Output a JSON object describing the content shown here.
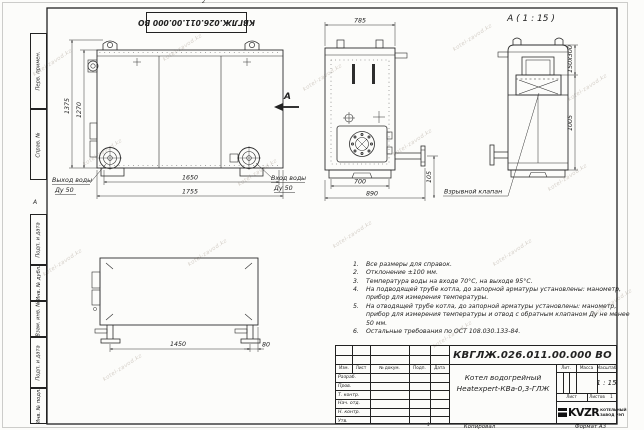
{
  "watermark": "kotel-zavod.kz",
  "frame": {
    "zone_top": "2",
    "zone_left": "А",
    "copy_tick": "1"
  },
  "stamp_top": {
    "doc_number": "КВГЛЖ.026.011.00.000 ВО"
  },
  "sidebar": {
    "items": [
      {
        "label": "Перв. примен."
      },
      {
        "label": "Справ. №"
      },
      {
        "label": "Подп. и дата"
      },
      {
        "label": "Инв. № дубл."
      },
      {
        "label": "Взам. инв. №"
      },
      {
        "label": "Подп. и дата"
      },
      {
        "label": "Инв. № подл."
      }
    ]
  },
  "views": {
    "side": {
      "dim_height_total": "1375",
      "dim_height_body": "1270",
      "dim_width_inner": "1650",
      "dim_width_total": "1755",
      "outlet_label": "Выход воды",
      "outlet_dn": "Ду 50",
      "inlet_label": "Вход воды",
      "inlet_dn": "Ду 50",
      "section_arrow": "А"
    },
    "front": {
      "dim_width_top": "785",
      "dim_width_inner": "700",
      "dim_width_total": "890",
      "dim_pipe_height": "105"
    },
    "section": {
      "title": "А ( 1 : 15 )",
      "dim_opening": "150х300",
      "dim_height": "1005",
      "valve_label": "Взрывной клапан"
    },
    "plan": {
      "dim_leg_span": "1450",
      "dim_edge_offset": "80"
    }
  },
  "notes": [
    {
      "num": "1.",
      "text": "Все размеры для справок."
    },
    {
      "num": "2.",
      "text": "Отклонение ±100 мм."
    },
    {
      "num": "3.",
      "text": "Температура воды на входе 70°С, на выходе 95°С."
    },
    {
      "num": "4.",
      "text": "На подводящей трубе котла, до запорной арматуры установлены: манометр, прибор для измерения температуры."
    },
    {
      "num": "5.",
      "text": "На отводящей трубе котла, до запорной арматуры установлены: манометр, прибор для измерения температуры и отвод с обратным клапаном Ду не менее 50 мм."
    },
    {
      "num": "6.",
      "text": "Остальные требования по ОСТ 108.030.133-84."
    }
  ],
  "title_block": {
    "doc_number": "КВГЛЖ.026.011.00.000 ВО",
    "product_line1": "Котел водогрейный",
    "product_line2": "Heatexpert-КВа-0,3-ГЛЖ",
    "rev_cols": [
      {
        "label": "Изм."
      },
      {
        "label": "Лист"
      },
      {
        "label": "№ докум."
      },
      {
        "label": "Подп."
      },
      {
        "label": "Дата"
      }
    ],
    "staff_rows": [
      {
        "label": "Разраб."
      },
      {
        "label": "Пров."
      },
      {
        "label": "Т. контр."
      },
      {
        "label": "Нач. отд."
      },
      {
        "label": "Н. контр."
      },
      {
        "label": "Утв."
      }
    ],
    "lit_label": "Лит.",
    "mass_label": "Масса",
    "scale_label": "Масштаб",
    "scale_value": "1 : 15",
    "sheet_label": "Лист",
    "sheets_label": "Листов",
    "sheets_value": "1",
    "logo_text": "KVZR",
    "company_line1": "КОТЕЛЬНЫЙ",
    "company_line2": "ЗАВОД РЭП",
    "copied_label": "Копировал",
    "format_label": "Формат А3"
  }
}
